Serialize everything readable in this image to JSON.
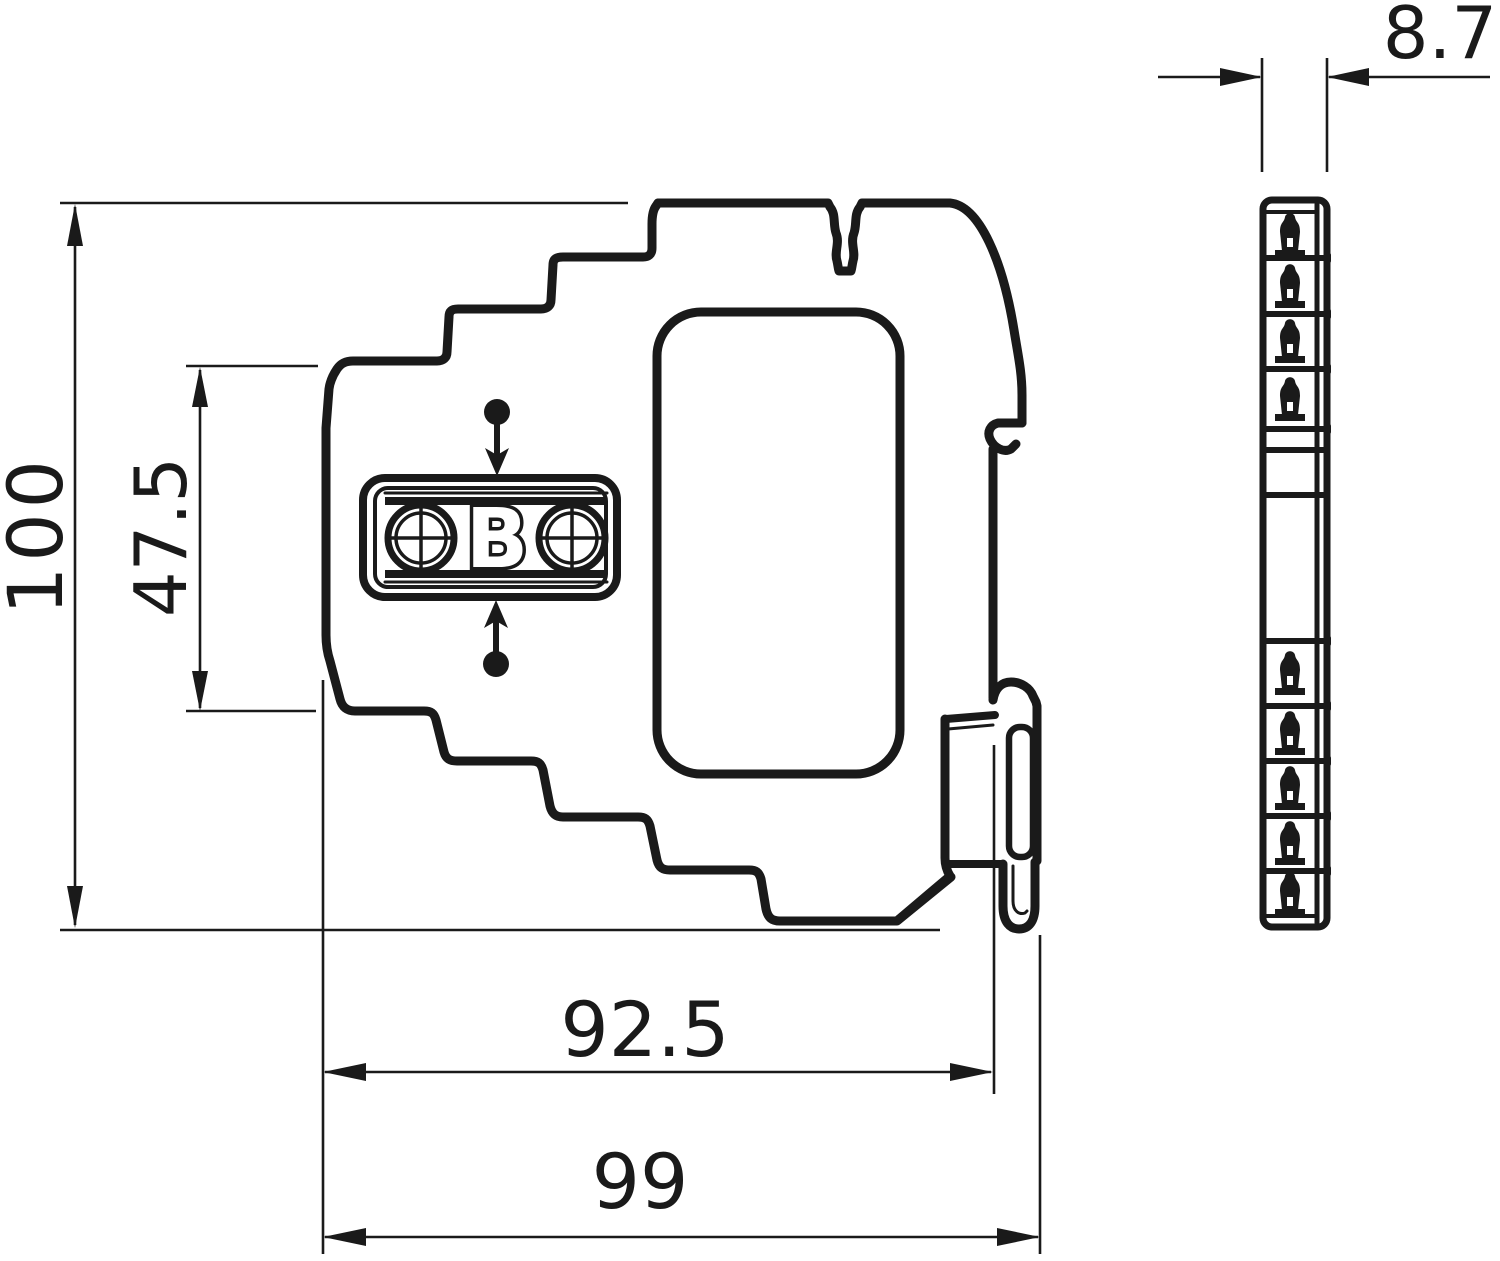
{
  "document": {
    "type": "technical-dimension-drawing",
    "background": "#ffffff",
    "line_color": "#1a1a1a"
  },
  "labels": {
    "overall_height": "100",
    "upper_height": "47.5",
    "body_width": "92.5",
    "overall_width": "99",
    "module_width": "8.7",
    "logo_letter": "B"
  }
}
